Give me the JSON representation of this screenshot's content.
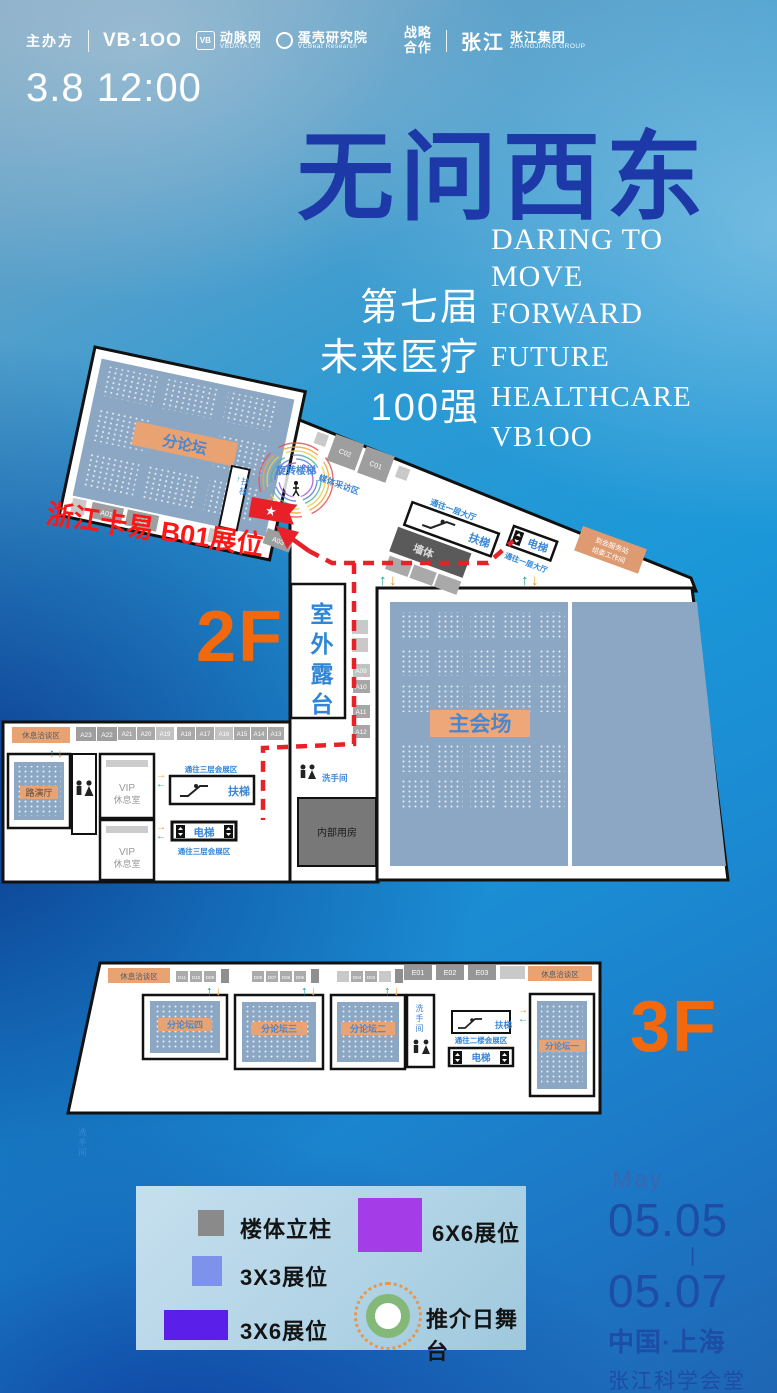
{
  "colors": {
    "accent_orange": "#F2690D",
    "room_fill": "#8CA7C4",
    "band_orange": "#E9A271",
    "route_red": "#E82129",
    "annotation_red": "#FF1616",
    "legend_gray": "#8A8A8A",
    "legend_blue": "#7D92EA",
    "legend_violet": "#5A1FE8",
    "legend_purple": "#A43CE8",
    "stage_green": "#84B878",
    "title_blue": "#1D39A8",
    "date_blue": "#1D4DA5",
    "map_text_blue": "#3C87D8"
  },
  "header": {
    "host": "主办方",
    "vb100": "VB·1OO",
    "vbdata_badge": "VB",
    "vbdata_name": "动脉网",
    "vbdata_site": "VBDATA.CN",
    "vcbeat_name": "蛋壳研究院",
    "vcbeat_en": "VCBeat Research",
    "coop_l1": "战略",
    "coop_l2": "合作",
    "zj_logo": "张江",
    "zj_name": "张江集团",
    "zj_en": "ZHANGJIANG GROUP"
  },
  "datetime": "3.8 12:00",
  "title": {
    "cn": "无问西东",
    "en1": [
      "DARING TO",
      "MOVE",
      "FORWARD"
    ],
    "session": [
      "第七届",
      "未来医疗",
      "100强"
    ],
    "en2": [
      "FUTURE",
      "HEALTHCARE",
      "VB1OO"
    ]
  },
  "floor2": {
    "label": "2F",
    "annotation": "浙江卡易 B01展位",
    "forum": "分论坛",
    "main_hall": "主会场",
    "terrace": "室外露台",
    "internal": "内部用房",
    "spiral": "旋转楼梯",
    "media": "媒体采访区",
    "wall": "墙体",
    "escalator": "扶梯",
    "elevator": "电梯",
    "to_lobby": "通往一层大厅",
    "org1": "到会服务站",
    "org2": "组委工作间",
    "lounge": "休息洽谈区",
    "roadshow": "路演厅",
    "restroom": "洗手间",
    "vip1": "VIP",
    "vip2": "休息室",
    "to_f3": "通往三层会展区",
    "top_booths": [
      "A23",
      "A22",
      "A21",
      "A20",
      "A19",
      "A18",
      "A17",
      "A16",
      "A15",
      "A14",
      "A13"
    ],
    "side_booths": [
      "A09",
      "A10",
      "A11",
      "A12"
    ],
    "c_booths": [
      "C02",
      "C01"
    ],
    "strip_booths": [
      "A01",
      "A02"
    ],
    "near_flag_booth": "A03"
  },
  "floor3": {
    "label": "3F",
    "lounge": "休息洽谈区",
    "rooms": [
      "分论坛四",
      "分论坛三",
      "分论坛二",
      "分论坛一"
    ],
    "restroom": "洗手间",
    "escalator": "扶梯",
    "elevator": "电梯",
    "to_f2": "通往二楼会展区",
    "d_booths": [
      "D11",
      "D10",
      "D09",
      "D08",
      "D07",
      "D06",
      "D05",
      "D04",
      "D03"
    ],
    "e_booths": [
      "E01",
      "E02",
      "E03"
    ]
  },
  "legend": {
    "column": "楼体立柱",
    "b33": "3X3展位",
    "b36": "3X6展位",
    "b66": "6X6展位",
    "stage": "推介日舞台"
  },
  "footer": {
    "month": "May",
    "start": "05.05",
    "sep": "|",
    "end": "05.07",
    "city": "中国·上海",
    "venue": "张江科学会堂"
  }
}
